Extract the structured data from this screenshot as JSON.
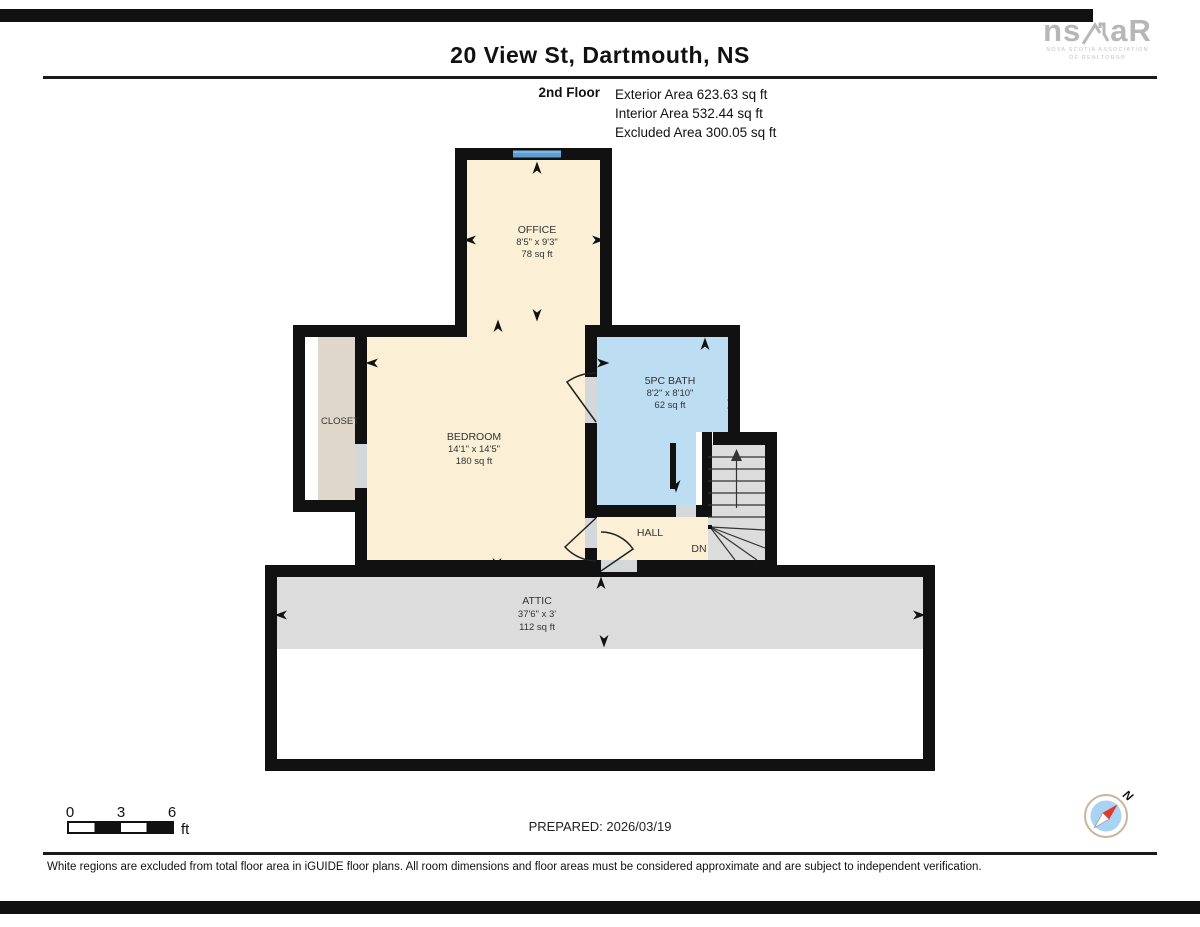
{
  "page": {
    "title": "20 View St, Dartmouth, NS",
    "prepared": "PREPARED: 2026/03/19",
    "disclaimer": "White regions are excluded from total floor area in iGUIDE floor plans. All room dimensions and floor areas must be considered approximate and are subject to independent verification."
  },
  "brand": {
    "logo_left": "ns",
    "logo_right": "aR",
    "sub1": "NOVA SCOTIA ASSOCIATION",
    "sub2": "OF REALTORS®"
  },
  "floor_info": {
    "floor": "2nd Floor",
    "exterior": "Exterior Area 623.63 sq ft",
    "interior": "Interior Area 532.44 sq ft",
    "excluded": "Excluded Area 300.05 sq ft"
  },
  "rooms": {
    "office": {
      "name": "OFFICE",
      "dims": "8'5\" x 9'3\"",
      "area": "78 sq ft"
    },
    "bedroom": {
      "name": "BEDROOM",
      "dims": "14'1\" x 14'5\"",
      "area": "180 sq ft"
    },
    "bath": {
      "name": "5PC BATH",
      "dims": "8'2\" x 8'10\"",
      "area": "62 sq ft"
    },
    "closet": {
      "name": "CLOSET"
    },
    "hall": {
      "name": "HALL"
    },
    "attic": {
      "name": "ATTIC",
      "dims": "37'6\" x 3'",
      "area": "112 sq ft"
    }
  },
  "labels": {
    "down": "DN",
    "north": "N",
    "scale_0": "0",
    "scale_3": "3",
    "scale_6": "6",
    "scale_unit": "ft"
  },
  "colors": {
    "wall": "#111111",
    "room_cream": "#FBF0D5",
    "bath_blue": "#BDDDF3",
    "window_blue": "#5B9FD6",
    "excluded_gray": "#DCDCDC",
    "closet_tan": "#DFD7C9",
    "door_gap": "#D5D8DB",
    "compass_red": "#E03A2F",
    "compass_blue": "#A9D3F2"
  }
}
